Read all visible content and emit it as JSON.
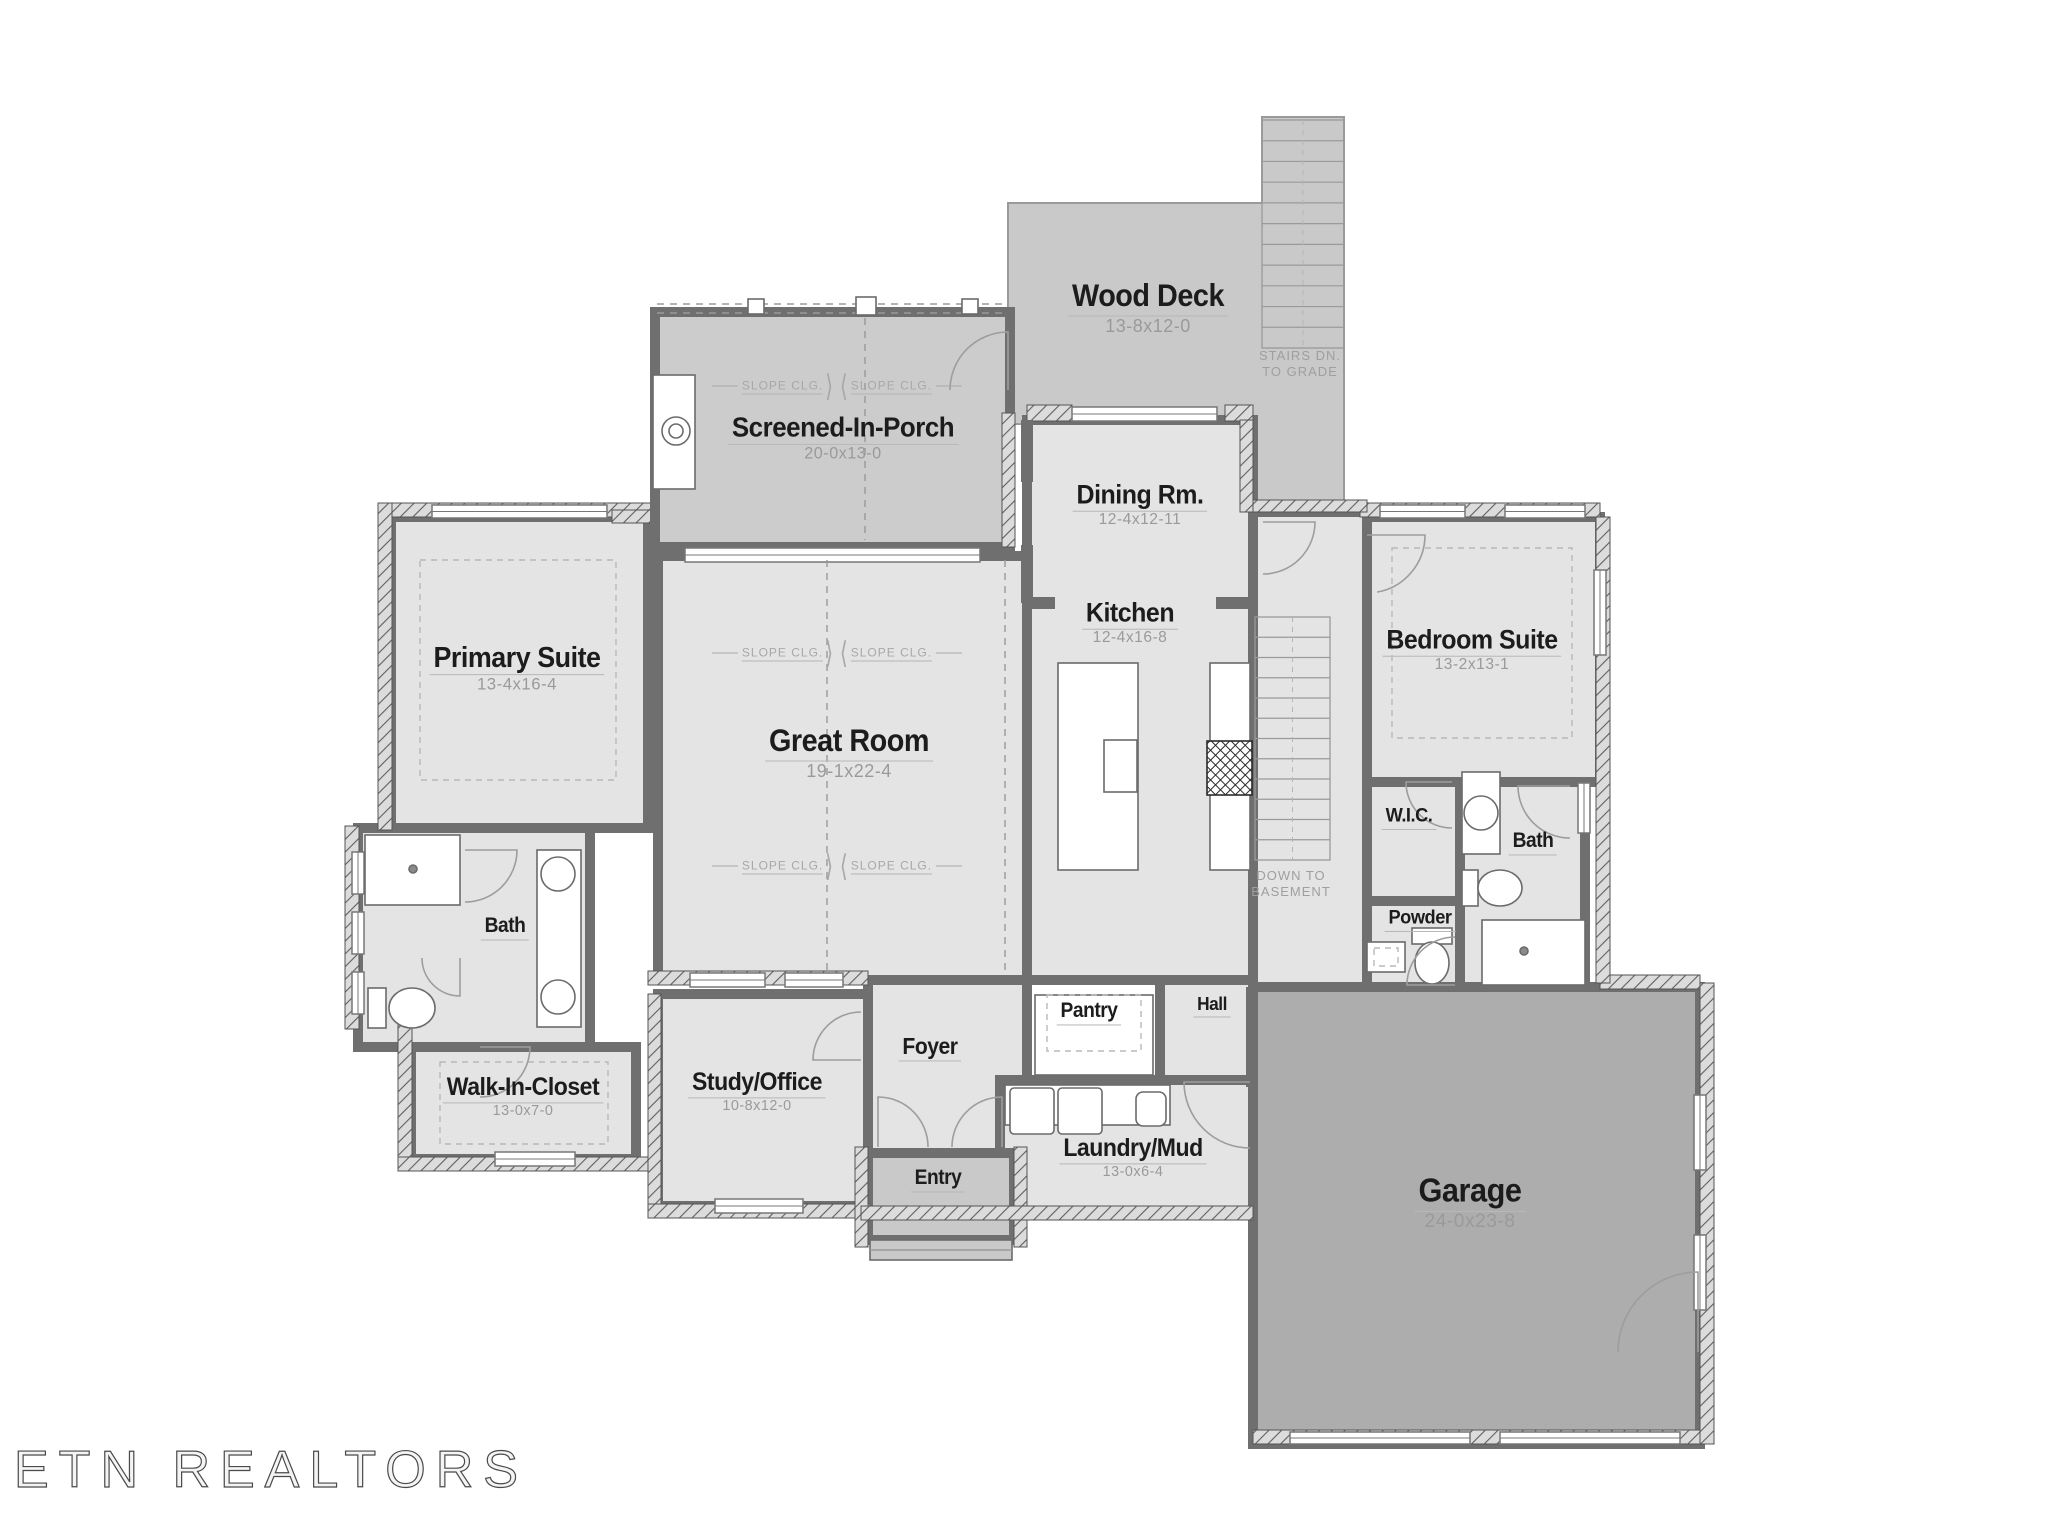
{
  "watermark": "ETN REALTORS",
  "slope_text": "SLOPE CLG.",
  "notes": [
    {
      "name": "stairs-down-note",
      "text": "STAIRS DN.\nTO GRADE",
      "x": 1300,
      "y": 364
    },
    {
      "name": "basement-note",
      "text": "DOWN TO\nBASEMENT",
      "x": 1291,
      "y": 884
    }
  ],
  "slopes": [
    {
      "x": 772,
      "y": 386,
      "dir": 1
    },
    {
      "x": 902,
      "y": 386,
      "dir": -1
    },
    {
      "x": 772,
      "y": 653,
      "dir": 1
    },
    {
      "x": 902,
      "y": 653,
      "dir": -1
    },
    {
      "x": 772,
      "y": 866,
      "dir": 1
    },
    {
      "x": 902,
      "y": 866,
      "dir": -1
    }
  ],
  "labels": [
    {
      "id": "wood-deck",
      "text": "Wood Deck",
      "dims": "13-8x12-0",
      "x": 1148,
      "y": 308,
      "size": 30
    },
    {
      "id": "screened-in-porch",
      "text": "Screened-In-Porch",
      "dims": "20-0x13-0",
      "x": 843,
      "y": 438,
      "size": 27
    },
    {
      "id": "dining-rm",
      "text": "Dining Rm.",
      "dims": "12-4x12-11",
      "x": 1140,
      "y": 505,
      "size": 26
    },
    {
      "id": "kitchen",
      "text": "Kitchen",
      "dims": "12-4x16-8",
      "x": 1130,
      "y": 623,
      "size": 26
    },
    {
      "id": "bedroom-suite",
      "text": "Bedroom Suite",
      "dims": "13-2x13-1",
      "x": 1472,
      "y": 650,
      "size": 26
    },
    {
      "id": "primary-suite",
      "text": "Primary Suite",
      "dims": "13-4x16-4",
      "x": 517,
      "y": 668,
      "size": 28
    },
    {
      "id": "great-room",
      "text": "Great Room",
      "dims": "19-1x22-4",
      "x": 849,
      "y": 753,
      "size": 30
    },
    {
      "id": "wic-2",
      "text": "W.I.C.",
      "dims": null,
      "x": 1409,
      "y": 818,
      "size": 19
    },
    {
      "id": "bath-2",
      "text": "Bath",
      "dims": null,
      "x": 1533,
      "y": 843,
      "size": 20
    },
    {
      "id": "bath-1",
      "text": "Bath",
      "dims": null,
      "x": 505,
      "y": 928,
      "size": 20
    },
    {
      "id": "powder",
      "text": "Powder",
      "dims": null,
      "x": 1420,
      "y": 920,
      "size": 19
    },
    {
      "id": "hall",
      "text": "Hall",
      "dims": null,
      "x": 1212,
      "y": 1006,
      "size": 18
    },
    {
      "id": "pantry",
      "text": "Pantry",
      "dims": null,
      "x": 1089,
      "y": 1013,
      "size": 20
    },
    {
      "id": "foyer",
      "text": "Foyer",
      "dims": null,
      "x": 930,
      "y": 1048,
      "size": 22
    },
    {
      "id": "study-office",
      "text": "Study/Office",
      "dims": "10-8x12-0",
      "x": 757,
      "y": 1092,
      "size": 24
    },
    {
      "id": "walk-in-closet",
      "text": "Walk-In-Closet",
      "dims": "13-0x7-0",
      "x": 523,
      "y": 1097,
      "size": 24
    },
    {
      "id": "laundry-mud",
      "text": "Laundry/Mud",
      "dims": "13-0x6-4",
      "x": 1133,
      "y": 1158,
      "size": 24
    },
    {
      "id": "entry",
      "text": "Entry",
      "dims": null,
      "x": 938,
      "y": 1180,
      "size": 20
    },
    {
      "id": "garage",
      "text": "Garage",
      "dims": "24-0x23-8",
      "x": 1470,
      "y": 1203,
      "size": 32
    }
  ],
  "plan": {
    "colors": {
      "room": "#e4e4e4",
      "porch": "#cccccc",
      "deck": "#c9c9c9",
      "garage": "#adadad",
      "wall": "#6f6f6f",
      "thin": "#9a9a9a",
      "fixture": "#ffffff",
      "dash": "#b8b8b8"
    },
    "deck_path": "M1008,203 L1262,203 L1262,117 L1344,117 L1344,512 L1253,512 L1253,424 L1008,424 Z",
    "areas": [
      {
        "name": "area-screened-porch",
        "x": 655,
        "y": 312,
        "w": 355,
        "h": 235,
        "fill": "porch"
      },
      {
        "name": "area-primary-suite",
        "x": 391,
        "y": 517,
        "w": 257,
        "h": 311,
        "fill": "room"
      },
      {
        "name": "area-great-room",
        "x": 658,
        "y": 556,
        "w": 369,
        "h": 424,
        "fill": "room"
      },
      {
        "name": "area-dining-kitchen",
        "x": 1027,
        "y": 420,
        "w": 226,
        "h": 560,
        "fill": "room"
      },
      {
        "name": "area-hall-connector",
        "x": 1253,
        "y": 512,
        "w": 114,
        "h": 475,
        "fill": "room"
      },
      {
        "name": "area-bedroom-suite",
        "x": 1367,
        "y": 517,
        "w": 233,
        "h": 265,
        "fill": "room"
      },
      {
        "name": "area-wic-2",
        "x": 1367,
        "y": 782,
        "w": 93,
        "h": 119,
        "fill": "room"
      },
      {
        "name": "area-bath-2",
        "x": 1460,
        "y": 782,
        "w": 125,
        "h": 205,
        "fill": "room"
      },
      {
        "name": "area-powder",
        "x": 1367,
        "y": 901,
        "w": 93,
        "h": 86,
        "fill": "room"
      },
      {
        "name": "area-bath-1",
        "x": 358,
        "y": 828,
        "w": 232,
        "h": 219,
        "fill": "room"
      },
      {
        "name": "area-walk-in-closet",
        "x": 411,
        "y": 1047,
        "w": 225,
        "h": 112,
        "fill": "room"
      },
      {
        "name": "area-study",
        "x": 658,
        "y": 994,
        "w": 210,
        "h": 212,
        "fill": "room"
      },
      {
        "name": "area-foyer",
        "x": 868,
        "y": 980,
        "w": 159,
        "h": 173,
        "fill": "room"
      },
      {
        "name": "area-hall",
        "x": 1160,
        "y": 980,
        "w": 93,
        "h": 100,
        "fill": "room"
      },
      {
        "name": "area-laundry",
        "x": 1000,
        "y": 1080,
        "w": 253,
        "h": 132,
        "fill": "room"
      },
      {
        "name": "area-entry",
        "x": 868,
        "y": 1153,
        "w": 146,
        "h": 87,
        "fill": "deck"
      },
      {
        "name": "area-garage",
        "x": 1253,
        "y": 987,
        "w": 447,
        "h": 457,
        "fill": "garage"
      }
    ],
    "hatch": [
      [
        380,
        503,
        272,
        14
      ],
      [
        378,
        503,
        14,
        327
      ],
      [
        345,
        826,
        14,
        203
      ],
      [
        398,
        1025,
        14,
        136
      ],
      [
        398,
        1157,
        252,
        14
      ],
      [
        648,
        994,
        13,
        212
      ],
      [
        648,
        1204,
        222,
        14
      ],
      [
        648,
        971,
        220,
        14
      ],
      [
        855,
        1147,
        13,
        100
      ],
      [
        1014,
        1147,
        13,
        100
      ],
      [
        861,
        1206,
        392,
        14
      ],
      [
        1253,
        1430,
        460,
        14
      ],
      [
        1700,
        983,
        14,
        461
      ],
      [
        1600,
        975,
        100,
        14
      ],
      [
        1360,
        503,
        240,
        14
      ],
      [
        1596,
        517,
        14,
        466
      ],
      [
        1027,
        405,
        45,
        16
      ],
      [
        1225,
        405,
        28,
        16
      ],
      [
        1240,
        420,
        13,
        92
      ],
      [
        1253,
        500,
        114,
        12
      ],
      [
        1002,
        413,
        13,
        134
      ],
      [
        612,
        510,
        40,
        13
      ]
    ],
    "stubs": [
      [
        650,
        315,
        10,
        240
      ],
      [
        1021,
        420,
        12,
        62
      ],
      [
        1021,
        545,
        12,
        58
      ],
      [
        1027,
        597,
        28,
        12
      ],
      [
        1216,
        597,
        36,
        12
      ],
      [
        1246,
        987,
        12,
        100
      ]
    ],
    "windows": [
      [
        432,
        505,
        175,
        13
      ],
      [
        685,
        548,
        295,
        14
      ],
      [
        1072,
        407,
        145,
        14
      ],
      [
        1380,
        505,
        85,
        13
      ],
      [
        1505,
        505,
        80,
        13
      ],
      [
        1594,
        570,
        12,
        85
      ],
      [
        1578,
        783,
        12,
        50
      ],
      [
        352,
        852,
        12,
        42
      ],
      [
        352,
        912,
        12,
        42
      ],
      [
        352,
        972,
        12,
        42
      ],
      [
        495,
        1152,
        80,
        14
      ],
      [
        715,
        1199,
        88,
        14
      ],
      [
        690,
        973,
        75,
        14
      ],
      [
        785,
        973,
        58,
        14
      ],
      [
        1694,
        1095,
        12,
        75
      ],
      [
        1694,
        1235,
        12,
        75
      ],
      [
        1290,
        1432,
        180,
        12
      ],
      [
        1500,
        1432,
        180,
        12
      ]
    ],
    "doors": [
      [
        1008,
        390,
        58,
        -90,
        180
      ],
      [
        1263,
        522,
        52,
        0,
        90
      ],
      [
        1367,
        535,
        58,
        0,
        80
      ],
      [
        1452,
        782,
        46,
        180,
        90
      ],
      [
        1570,
        786,
        52,
        180,
        90
      ],
      [
        1455,
        985,
        48,
        180,
        270
      ],
      [
        465,
        850,
        52,
        0,
        90
      ],
      [
        480,
        1047,
        50,
        0,
        90
      ],
      [
        460,
        958,
        38,
        90,
        180
      ],
      [
        878,
        1147,
        50,
        -90,
        0
      ],
      [
        1002,
        1147,
        50,
        -90,
        180
      ],
      [
        861,
        1060,
        48,
        180,
        270
      ],
      [
        1250,
        1082,
        66,
        180,
        90
      ],
      [
        1698,
        1352,
        80,
        270,
        180
      ]
    ],
    "fixtures": [
      {
        "t": "treads",
        "name": "deck-stairs",
        "x": 1262,
        "y": 120,
        "w": 82,
        "h": 228,
        "n": 11
      },
      {
        "t": "treads",
        "name": "basement-stairs",
        "x": 1255,
        "y": 617,
        "w": 75,
        "h": 243,
        "n": 12
      },
      {
        "t": "rect",
        "name": "fireplace-box",
        "x": 653,
        "y": 375,
        "w": 42,
        "h": 114
      },
      {
        "t": "circ",
        "name": "fireplace-flue",
        "cx": 676,
        "cy": 431,
        "r": 14
      },
      {
        "t": "circ",
        "name": "fireplace-flue-inner",
        "cx": 676,
        "cy": 431,
        "r": 7
      },
      {
        "t": "line",
        "name": "porch-screen-line",
        "x1": 657,
        "y1": 304,
        "x2": 1008,
        "y2": 304,
        "dash": true
      },
      {
        "t": "line",
        "name": "porch-screen-line",
        "x1": 657,
        "y1": 313,
        "x2": 1008,
        "y2": 313,
        "dash": true
      },
      {
        "t": "rect",
        "name": "porch-post",
        "x": 748,
        "y": 299,
        "w": 16,
        "h": 15
      },
      {
        "t": "rect",
        "name": "porch-post",
        "x": 856,
        "y": 297,
        "w": 20,
        "h": 18
      },
      {
        "t": "rect",
        "name": "porch-post",
        "x": 962,
        "y": 299,
        "w": 16,
        "h": 15
      },
      {
        "t": "line",
        "name": "ceiling-break",
        "x1": 827,
        "y1": 560,
        "x2": 827,
        "y2": 975,
        "dash": true
      },
      {
        "t": "line",
        "name": "ceiling-break",
        "x1": 1005,
        "y1": 560,
        "x2": 1005,
        "y2": 975,
        "dash": true
      },
      {
        "t": "line",
        "name": "ceiling-break",
        "x1": 865,
        "y1": 318,
        "x2": 865,
        "y2": 540,
        "dash": true
      },
      {
        "t": "rect",
        "name": "kitchen-island",
        "x": 1058,
        "y": 663,
        "w": 80,
        "h": 207
      },
      {
        "t": "rect",
        "name": "island-sink",
        "x": 1104,
        "y": 740,
        "w": 33,
        "h": 52
      },
      {
        "t": "rect",
        "name": "kitchen-counter",
        "x": 1210,
        "y": 663,
        "w": 40,
        "h": 207
      },
      {
        "t": "hrect",
        "name": "range",
        "x": 1207,
        "y": 741,
        "w": 45,
        "h": 54
      },
      {
        "t": "rect",
        "name": "pantry-shelves",
        "x": 1035,
        "y": 995,
        "w": 118,
        "h": 80
      },
      {
        "t": "drect",
        "name": "pantry-shelf-inner",
        "x": 1047,
        "y": 995,
        "w": 94,
        "h": 56
      },
      {
        "t": "rect",
        "name": "laundry-counter",
        "x": 1005,
        "y": 1085,
        "w": 165,
        "h": 40
      },
      {
        "t": "rect",
        "name": "washer",
        "x": 1010,
        "y": 1088,
        "w": 44,
        "h": 46,
        "rx": 4
      },
      {
        "t": "rect",
        "name": "dryer",
        "x": 1058,
        "y": 1088,
        "w": 44,
        "h": 46,
        "rx": 4
      },
      {
        "t": "rect",
        "name": "laundry-sink",
        "x": 1136,
        "y": 1092,
        "w": 30,
        "h": 34,
        "rx": 7
      },
      {
        "t": "rect",
        "name": "shower-1",
        "x": 365,
        "y": 835,
        "w": 95,
        "h": 70
      },
      {
        "t": "circ",
        "name": "shower-1-drain",
        "cx": 413,
        "cy": 869,
        "r": 4,
        "fill": "#8a8a8a"
      },
      {
        "t": "rect",
        "name": "vanity-1",
        "x": 537,
        "y": 850,
        "w": 44,
        "h": 177
      },
      {
        "t": "circ",
        "name": "sink",
        "cx": 558,
        "cy": 874,
        "r": 17
      },
      {
        "t": "circ",
        "name": "sink",
        "cx": 558,
        "cy": 997,
        "r": 17
      },
      {
        "t": "rect",
        "name": "toilet-tank",
        "x": 368,
        "y": 988,
        "w": 18,
        "h": 40
      },
      {
        "t": "ell",
        "name": "toilet-bowl",
        "cx": 412,
        "cy": 1008,
        "rx": 23,
        "ry": 20
      },
      {
        "t": "rect",
        "name": "vanity-2",
        "x": 1462,
        "y": 772,
        "w": 38,
        "h": 82
      },
      {
        "t": "circ",
        "name": "sink",
        "cx": 1481,
        "cy": 813,
        "r": 17
      },
      {
        "t": "rect",
        "name": "toilet-tank",
        "x": 1462,
        "y": 870,
        "w": 16,
        "h": 36
      },
      {
        "t": "ell",
        "name": "toilet-bowl",
        "cx": 1500,
        "cy": 888,
        "rx": 22,
        "ry": 18
      },
      {
        "t": "rect",
        "name": "shower-2",
        "x": 1482,
        "y": 920,
        "w": 103,
        "h": 65
      },
      {
        "t": "circ",
        "name": "shower-2-drain",
        "cx": 1524,
        "cy": 951,
        "r": 4,
        "fill": "#8a8a8a"
      },
      {
        "t": "rect",
        "name": "toilet-tank",
        "x": 1412,
        "y": 928,
        "w": 40,
        "h": 16
      },
      {
        "t": "ell",
        "name": "toilet-bowl",
        "cx": 1432,
        "cy": 963,
        "rx": 17,
        "ry": 21
      },
      {
        "t": "rect",
        "name": "powder-sink",
        "x": 1367,
        "y": 942,
        "w": 38,
        "h": 30
      },
      {
        "t": "drect",
        "name": "powder-sink-inner",
        "x": 1374,
        "y": 948,
        "w": 24,
        "h": 18
      },
      {
        "t": "rect",
        "name": "entry-steps",
        "x": 870,
        "y": 1240,
        "w": 142,
        "h": 20,
        "fill": "#c9c9c9"
      },
      {
        "t": "line",
        "name": "entry-step-line",
        "x1": 870,
        "y1": 1250,
        "x2": 1012,
        "y2": 1250
      },
      {
        "t": "drect",
        "name": "primary-carpet",
        "x": 420,
        "y": 560,
        "w": 196,
        "h": 220
      },
      {
        "t": "drect",
        "name": "bedroom-carpet",
        "x": 1392,
        "y": 548,
        "w": 180,
        "h": 190
      },
      {
        "t": "drect",
        "name": "wic-carpet",
        "x": 440,
        "y": 1062,
        "w": 168,
        "h": 82
      }
    ]
  }
}
